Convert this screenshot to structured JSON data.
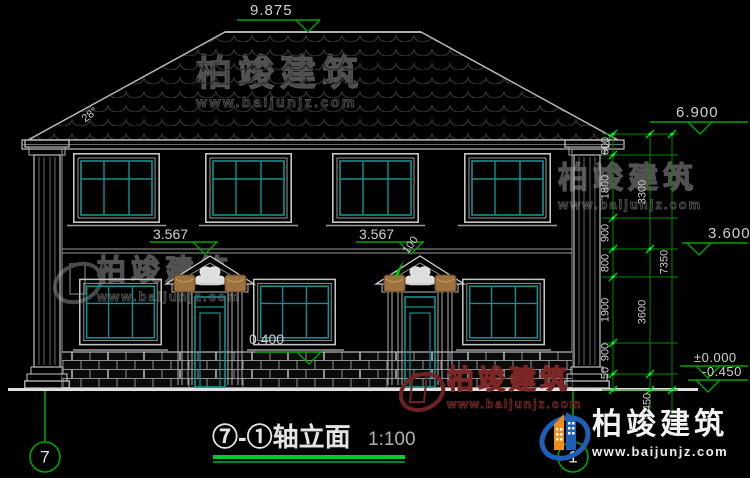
{
  "title_block": {
    "title": "⑦-①轴立面",
    "scale": "1:100"
  },
  "axis_bubbles": {
    "left": "7",
    "right": "1"
  },
  "levels": {
    "ridge": "9.875",
    "eave": "6.900",
    "upper": "3.600",
    "zero": "±0.000",
    "grade": "-0.450",
    "pediment_left": "3.567",
    "pediment_right": "3.567",
    "sill": "0.400"
  },
  "annotations": {
    "roof_slope": "28°",
    "pediment_offset": "100"
  },
  "dims": {
    "chain_inner": [
      "600",
      "1800",
      "900",
      "800",
      "1900",
      "900",
      "50"
    ],
    "chain_mid": [
      "3300",
      "3600",
      "450"
    ],
    "total": "7350"
  },
  "watermark": {
    "brand": "柏竣建筑",
    "url": "www.baijunjz.com"
  },
  "colors": {
    "dim_green": "#00a400",
    "window_teal": "#15918f",
    "capital_tan": "#9c7340",
    "watermark_red": "#7c2626"
  }
}
